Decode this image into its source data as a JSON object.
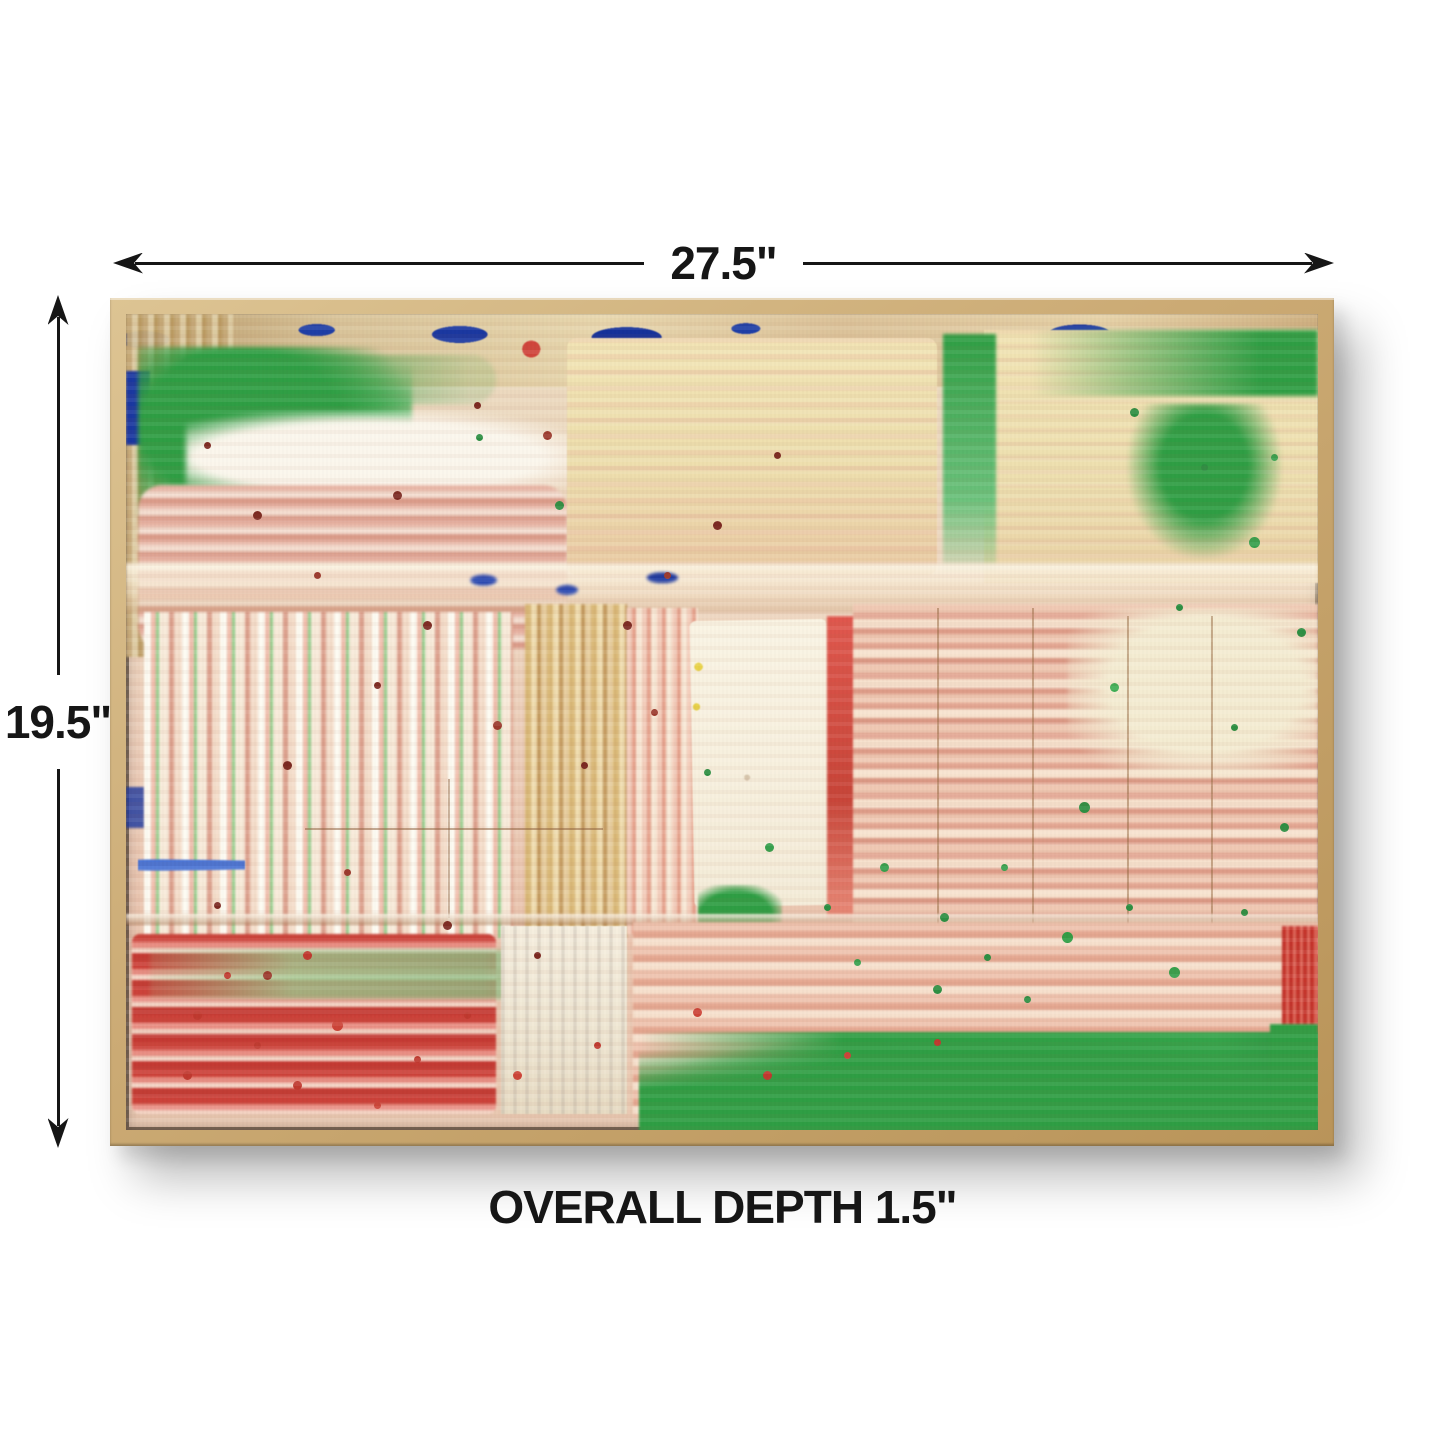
{
  "meta": {
    "type": "product-dimension-image",
    "background_color": "#ffffff",
    "annotation_color": "#161616"
  },
  "dimensions": {
    "width": {
      "label": "27.5\""
    },
    "height": {
      "label": "19.5\""
    },
    "depth": {
      "label": "OVERALL DEPTH 1.5\""
    }
  },
  "artwork": {
    "subject": "abstract squeegee-style acrylic painting",
    "frame": {
      "style": "natural wood float frame",
      "wood_color": "#cbaa74",
      "inner_lip_color": "#2e241a"
    },
    "palette": {
      "cream_yellow": "#eee3b4",
      "pale_pink": "#f0cdbc",
      "salmon": "#e5a892",
      "red": "#c53a31",
      "deep_red": "#7c2a22",
      "green": "#2f9e44",
      "light_green": "#93cf8d",
      "white": "#f7f0e1",
      "gold_tan": "#c9a86a",
      "blue": "#1b38a0"
    }
  }
}
